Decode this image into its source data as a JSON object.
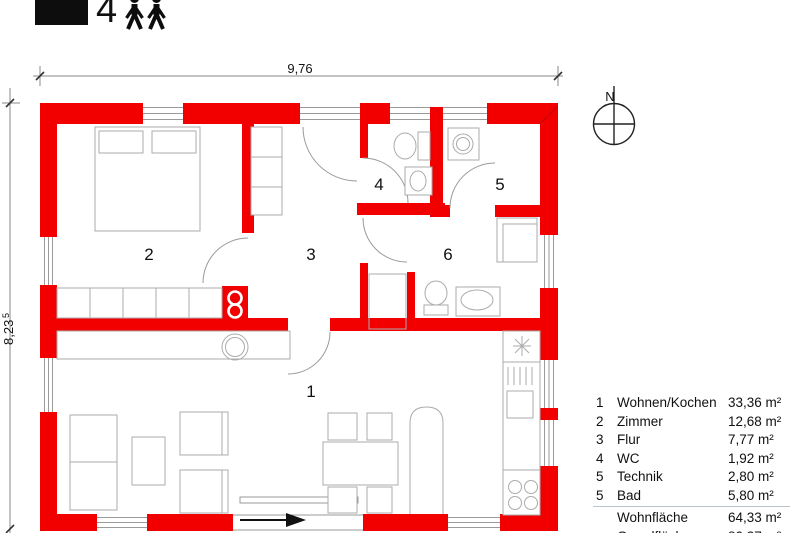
{
  "header": {
    "capacity": "4"
  },
  "dimensions": {
    "width": "9,76",
    "height": "8,23",
    "height_sup": "5"
  },
  "compass": {
    "north": "N"
  },
  "rooms": {
    "r1": "1",
    "r2": "2",
    "r3": "3",
    "r4": "4",
    "r5": "5",
    "r6": "6"
  },
  "legend": {
    "rows": [
      {
        "num": "1",
        "label": "Wohnen/Kochen",
        "area": "33,36 m²"
      },
      {
        "num": "2",
        "label": "Zimmer",
        "area": "12,68 m²"
      },
      {
        "num": "3",
        "label": "Flur",
        "area": "7,77 m²"
      },
      {
        "num": "4",
        "label": "WC",
        "area": "1,92 m²"
      },
      {
        "num": "5",
        "label": "Technik",
        "area": "2,80 m²"
      },
      {
        "num": "5",
        "label": "Bad",
        "area": "5,80 m²"
      }
    ],
    "summary": [
      {
        "label": "Wohnfläche",
        "area": "64,33 m²"
      },
      {
        "label": "Grundfläche",
        "area": "80,37 m²"
      }
    ]
  },
  "colors": {
    "wall_red": "#f20000"
  }
}
